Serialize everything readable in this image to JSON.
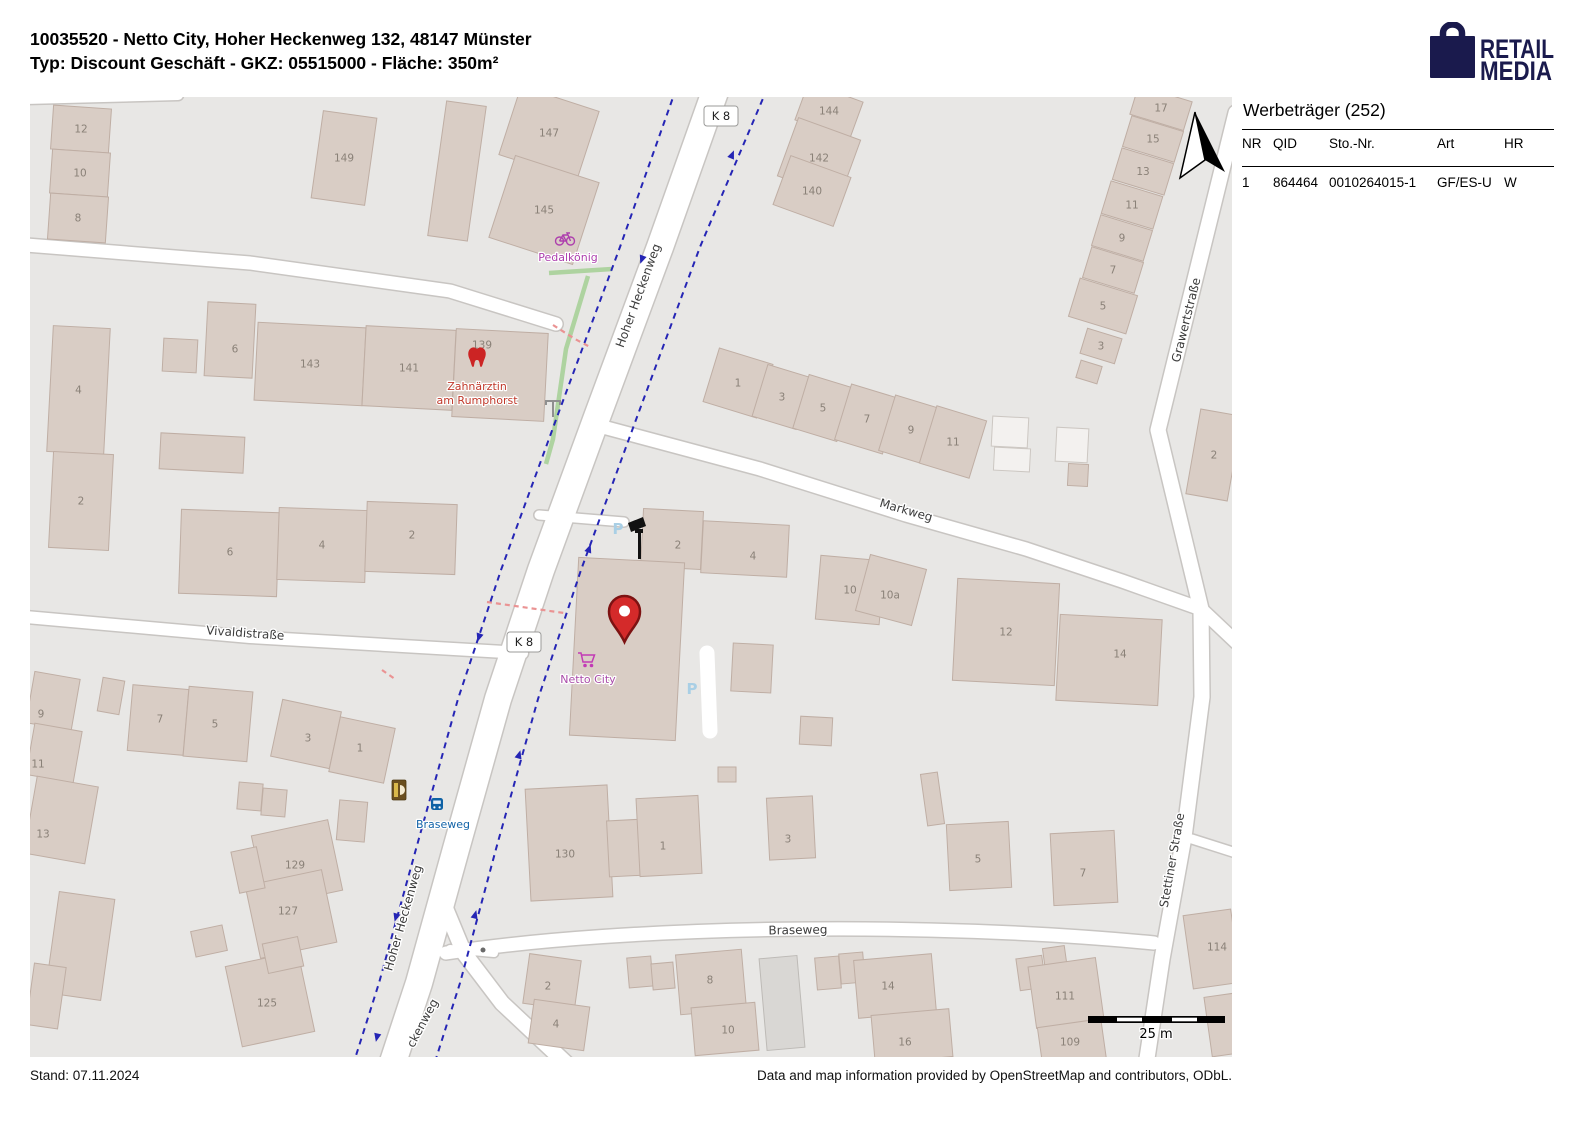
{
  "header": {
    "line1": "10035520 - Netto City, Hoher Heckenweg 132, 48147 Münster",
    "line2": "Typ: Discount Geschäft - GKZ: 05515000 - Fläche: 350m²",
    "logo": {
      "line1": "RETAIL",
      "line2": "MEDIA",
      "color": "#1a1a4d"
    }
  },
  "panel": {
    "title": "Werbeträger (252)",
    "columns": [
      "NR",
      "QID",
      "Sto.-Nr.",
      "Art",
      "HR"
    ],
    "rows": [
      [
        "1",
        "864464",
        "0010264015-1",
        "GF/ES-U",
        "W"
      ]
    ]
  },
  "footer": {
    "left": "Stand: 07.11.2024",
    "right": "Data and map information provided by OpenStreetMap and contributors, ODbL."
  },
  "map": {
    "colors": {
      "background": "#e8e7e5",
      "road": "#ffffff",
      "casing": "#c8c5c2",
      "building": "#d9cdc5",
      "cycleway": "#2525b5",
      "hedge": "#aed3a0",
      "poi_magenta": "#ad3fad",
      "poi_red": "#c0392b",
      "poi_purple": "#a94ca9",
      "transit_blue": "#1464a8",
      "pin_red": "#d42a2a"
    },
    "scale_label": "25 m",
    "parking_symbol": "P",
    "parking_positions": [
      {
        "x": 588,
        "y": 437
      },
      {
        "x": 662,
        "y": 597
      }
    ],
    "road_refs": [
      {
        "label": "K 8",
        "x": 691,
        "y": 19
      },
      {
        "label": "K 8",
        "x": 494,
        "y": 545
      }
    ],
    "street_labels": [
      {
        "text": "Hoher Heckenweg",
        "x": 612,
        "y": 200,
        "r": -70
      },
      {
        "text": "Hoher Heckenweg",
        "x": 377,
        "y": 822,
        "r": -74
      },
      {
        "text": "ckenweg",
        "x": 396,
        "y": 928,
        "r": -62
      },
      {
        "text": "Vivaldistraße",
        "x": 215,
        "y": 540,
        "r": 4
      },
      {
        "text": "Markweg",
        "x": 875,
        "y": 417,
        "r": 16
      },
      {
        "text": "Braseweg",
        "x": 768,
        "y": 837,
        "r": -1
      },
      {
        "text": "Grawertstraße",
        "x": 1160,
        "y": 224,
        "r": -76
      },
      {
        "text": "Stettiner Straße",
        "x": 1146,
        "y": 764,
        "r": -80
      }
    ],
    "pois": {
      "bike_shop": {
        "label": "Pedalkönig"
      },
      "dentist": {
        "label_line1": "Zahnärztin",
        "label_line2": "am Rumphorst"
      },
      "supermarket": {
        "label": "Netto City"
      },
      "bus_stop": {
        "label": "Braseweg"
      }
    },
    "buildings": [
      {
        "n": "12",
        "x": 22,
        "y": 10,
        "w": 58,
        "h": 44,
        "r": 4
      },
      {
        "n": "10",
        "x": 21,
        "y": 54,
        "w": 58,
        "h": 44,
        "r": 4
      },
      {
        "n": "8",
        "x": 19,
        "y": 98,
        "w": 58,
        "h": 46,
        "r": 4
      },
      {
        "n": "149",
        "x": 287,
        "y": 17,
        "w": 54,
        "h": 88,
        "r": 8
      },
      {
        "x": 407,
        "y": 6,
        "w": 40,
        "h": 136,
        "r": 8
      },
      {
        "n": "147",
        "x": 478,
        "y": 0,
        "w": 82,
        "h": 72,
        "r": 18
      },
      {
        "n": "145",
        "x": 470,
        "y": 70,
        "w": 88,
        "h": 86,
        "r": 18
      },
      {
        "x": 133,
        "y": 242,
        "w": 34,
        "h": 33,
        "r": 3
      },
      {
        "n": "6",
        "x": 176,
        "y": 206,
        "w": 48,
        "h": 74,
        "r": 3,
        "lx": 205,
        "ly": 252
      },
      {
        "n": "143",
        "x": 226,
        "y": 228,
        "w": 108,
        "h": 78,
        "r": 3
      },
      {
        "n": "141",
        "x": 334,
        "y": 231,
        "w": 90,
        "h": 80,
        "r": 3
      },
      {
        "n": "139",
        "x": 424,
        "y": 234,
        "w": 92,
        "h": 88,
        "r": 3,
        "lx": 452,
        "ly": 248
      },
      {
        "n": "4",
        "x": 20,
        "y": 230,
        "w": 57,
        "h": 126,
        "r": 3
      },
      {
        "n": "2",
        "x": 21,
        "y": 356,
        "w": 60,
        "h": 96,
        "r": 3
      },
      {
        "x": 130,
        "y": 338,
        "w": 84,
        "h": 36,
        "r": 3
      },
      {
        "n": "6",
        "x": 150,
        "y": 414,
        "w": 98,
        "h": 84,
        "r": 2,
        "lx": 200,
        "ly": 455
      },
      {
        "n": "4",
        "x": 248,
        "y": 412,
        "w": 88,
        "h": 72,
        "r": 2
      },
      {
        "n": "2",
        "x": 336,
        "y": 406,
        "w": 90,
        "h": 70,
        "r": 2,
        "lx": 382,
        "ly": 438
      },
      {
        "n": "144",
        "x": 770,
        "y": -6,
        "w": 58,
        "h": 40,
        "r": 20
      },
      {
        "n": "142",
        "x": 756,
        "y": 30,
        "w": 66,
        "h": 62,
        "r": 20
      },
      {
        "n": "140",
        "x": 750,
        "y": 68,
        "w": 64,
        "h": 52,
        "r": 20
      },
      {
        "n": "1",
        "x": 680,
        "y": 258,
        "w": 56,
        "h": 56,
        "r": 17
      },
      {
        "n": "3",
        "x": 729,
        "y": 273,
        "w": 46,
        "h": 54,
        "r": 17
      },
      {
        "n": "5",
        "x": 770,
        "y": 283,
        "w": 46,
        "h": 56,
        "r": 17
      },
      {
        "n": "7",
        "x": 812,
        "y": 293,
        "w": 50,
        "h": 58,
        "r": 17
      },
      {
        "n": "9",
        "x": 856,
        "y": 304,
        "w": 50,
        "h": 58,
        "r": 17
      },
      {
        "n": "11",
        "x": 897,
        "y": 315,
        "w": 52,
        "h": 60,
        "r": 17
      },
      {
        "n": "17",
        "x": 1103,
        "y": -4,
        "w": 56,
        "h": 30,
        "r": 17
      },
      {
        "n": "15",
        "x": 1096,
        "y": 26,
        "w": 54,
        "h": 32,
        "r": 17
      },
      {
        "n": "13",
        "x": 1086,
        "y": 58,
        "w": 54,
        "h": 33,
        "r": 17
      },
      {
        "n": "11",
        "x": 1075,
        "y": 91,
        "w": 54,
        "h": 34,
        "r": 17
      },
      {
        "n": "9",
        "x": 1065,
        "y": 125,
        "w": 54,
        "h": 32,
        "r": 17
      },
      {
        "n": "7",
        "x": 1056,
        "y": 157,
        "w": 54,
        "h": 32,
        "r": 17
      },
      {
        "n": "5",
        "x": 1043,
        "y": 189,
        "w": 60,
        "h": 40,
        "r": 17
      },
      {
        "n": "3",
        "x": 1053,
        "y": 236,
        "w": 36,
        "h": 26,
        "r": 17
      },
      {
        "x": 1048,
        "y": 266,
        "w": 22,
        "h": 18,
        "r": 17
      },
      {
        "n": "2",
        "x": 1163,
        "y": 315,
        "w": 42,
        "h": 86,
        "r": 10
      },
      {
        "n": "2",
        "x": 612,
        "y": 413,
        "w": 60,
        "h": 58,
        "r": 3,
        "lx": 648,
        "ly": 448
      },
      {
        "n": "4",
        "x": 672,
        "y": 426,
        "w": 86,
        "h": 52,
        "r": 3,
        "lx": 723,
        "ly": 459
      },
      {
        "x": 544,
        "y": 463,
        "w": 106,
        "h": 178,
        "r": 3,
        "name": "netto-building"
      },
      {
        "n": "10",
        "x": 788,
        "y": 461,
        "w": 64,
        "h": 64,
        "r": 5
      },
      {
        "n": "10a",
        "x": 832,
        "y": 464,
        "w": 58,
        "h": 58,
        "r": 15,
        "lx": 860,
        "ly": 498
      },
      {
        "n": "12",
        "x": 925,
        "y": 484,
        "w": 102,
        "h": 102,
        "r": 3
      },
      {
        "n": "14",
        "x": 1028,
        "y": 520,
        "w": 102,
        "h": 86,
        "r": 3,
        "lx": 1090,
        "ly": 557
      },
      {
        "x": 962,
        "y": 320,
        "w": 36,
        "h": 30,
        "r": 3,
        "v": "light"
      },
      {
        "x": 964,
        "y": 351,
        "w": 36,
        "h": 23,
        "r": 3,
        "v": "light"
      },
      {
        "x": 1026,
        "y": 331,
        "w": 32,
        "h": 34,
        "r": 3,
        "v": "light"
      },
      {
        "x": 1038,
        "y": 367,
        "w": 20,
        "h": 22,
        "r": 3
      },
      {
        "x": 702,
        "y": 547,
        "w": 40,
        "h": 48,
        "r": 3
      },
      {
        "x": 770,
        "y": 620,
        "w": 32,
        "h": 28,
        "r": 3
      },
      {
        "n": "9",
        "x": 0,
        "y": 578,
        "w": 46,
        "h": 52,
        "r": 10,
        "lx": 11,
        "ly": 617
      },
      {
        "n": "11",
        "x": 0,
        "y": 630,
        "w": 48,
        "h": 52,
        "r": 10,
        "lx": 8,
        "ly": 667
      },
      {
        "n": "13",
        "x": 0,
        "y": 684,
        "w": 62,
        "h": 78,
        "r": 10,
        "lx": 13,
        "ly": 737
      },
      {
        "x": 70,
        "y": 582,
        "w": 22,
        "h": 34,
        "r": 10
      },
      {
        "n": "7",
        "x": 100,
        "y": 590,
        "w": 56,
        "h": 66,
        "r": 5,
        "lx": 130,
        "ly": 622
      },
      {
        "n": "5",
        "x": 156,
        "y": 592,
        "w": 64,
        "h": 70,
        "r": 5,
        "lx": 185,
        "ly": 627
      },
      {
        "n": "3",
        "x": 246,
        "y": 608,
        "w": 60,
        "h": 58,
        "r": 12,
        "lx": 278,
        "ly": 641
      },
      {
        "n": "1",
        "x": 304,
        "y": 625,
        "w": 56,
        "h": 56,
        "r": 12,
        "lx": 330,
        "ly": 651
      },
      {
        "x": 208,
        "y": 686,
        "w": 24,
        "h": 27,
        "r": 5
      },
      {
        "x": 232,
        "y": 692,
        "w": 24,
        "h": 27,
        "r": 5
      },
      {
        "x": 308,
        "y": 704,
        "w": 28,
        "h": 40,
        "r": 5
      },
      {
        "n": "129",
        "x": 228,
        "y": 730,
        "w": 78,
        "h": 72,
        "r": -12,
        "lx": 265,
        "ly": 768
      },
      {
        "n": "127",
        "x": 222,
        "y": 780,
        "w": 78,
        "h": 74,
        "r": -12,
        "lx": 258,
        "ly": 814
      },
      {
        "x": 205,
        "y": 752,
        "w": 26,
        "h": 42,
        "r": -12
      },
      {
        "n": "125",
        "x": 203,
        "y": 861,
        "w": 74,
        "h": 82,
        "r": -12,
        "lx": 237,
        "ly": 906
      },
      {
        "x": 235,
        "y": 843,
        "w": 36,
        "h": 30,
        "r": -12
      },
      {
        "x": 163,
        "y": 831,
        "w": 32,
        "h": 26,
        "r": -12
      },
      {
        "x": 22,
        "y": 798,
        "w": 56,
        "h": 102,
        "r": 8
      },
      {
        "x": 0,
        "y": 868,
        "w": 32,
        "h": 62,
        "r": 8
      },
      {
        "n": "130",
        "x": 498,
        "y": 690,
        "w": 82,
        "h": 112,
        "r": -3,
        "lx": 535,
        "ly": 757
      },
      {
        "x": 578,
        "y": 723,
        "w": 36,
        "h": 56,
        "r": -3
      },
      {
        "n": "1",
        "x": 608,
        "y": 700,
        "w": 62,
        "h": 78,
        "r": -3,
        "lx": 633,
        "ly": 749
      },
      {
        "n": "3",
        "x": 738,
        "y": 700,
        "w": 46,
        "h": 62,
        "r": -3,
        "lx": 758,
        "ly": 742
      },
      {
        "x": 688,
        "y": 670,
        "w": 18,
        "h": 15,
        "r": 0
      },
      {
        "x": 894,
        "y": 676,
        "w": 17,
        "h": 52,
        "r": -8
      },
      {
        "n": "5",
        "x": 918,
        "y": 726,
        "w": 62,
        "h": 66,
        "r": -3,
        "lx": 948,
        "ly": 762
      },
      {
        "n": "7",
        "x": 1022,
        "y": 735,
        "w": 64,
        "h": 72,
        "r": -3,
        "lx": 1053,
        "ly": 776
      },
      {
        "n": "2",
        "x": 496,
        "y": 860,
        "w": 52,
        "h": 50,
        "r": 8,
        "lx": 518,
        "ly": 889
      },
      {
        "n": "4",
        "x": 501,
        "y": 906,
        "w": 56,
        "h": 44,
        "r": 8,
        "lx": 526,
        "ly": 927
      },
      {
        "x": 598,
        "y": 860,
        "w": 24,
        "h": 30,
        "r": -5
      },
      {
        "x": 622,
        "y": 866,
        "w": 22,
        "h": 26,
        "r": -5
      },
      {
        "n": "8",
        "x": 648,
        "y": 855,
        "w": 66,
        "h": 60,
        "r": -5,
        "lx": 680,
        "ly": 883
      },
      {
        "n": "10",
        "x": 663,
        "y": 908,
        "w": 64,
        "h": 48,
        "r": -5,
        "lx": 698,
        "ly": 933
      },
      {
        "x": 733,
        "y": 860,
        "w": 38,
        "h": 92,
        "r": -5,
        "v": "gray"
      },
      {
        "x": 786,
        "y": 860,
        "w": 24,
        "h": 32,
        "r": -5
      },
      {
        "x": 810,
        "y": 856,
        "w": 24,
        "h": 30,
        "r": -5
      },
      {
        "n": "14",
        "x": 826,
        "y": 860,
        "w": 78,
        "h": 58,
        "r": -5,
        "lx": 858,
        "ly": 889
      },
      {
        "n": "16",
        "x": 843,
        "y": 915,
        "w": 78,
        "h": 48,
        "r": -5,
        "lx": 875,
        "ly": 945
      },
      {
        "x": 988,
        "y": 860,
        "w": 26,
        "h": 32,
        "r": -8
      },
      {
        "x": 1014,
        "y": 850,
        "w": 22,
        "h": 24,
        "r": -8
      },
      {
        "n": "111",
        "x": 1002,
        "y": 865,
        "w": 68,
        "h": 62,
        "r": -8,
        "lx": 1035,
        "ly": 899
      },
      {
        "n": "109",
        "x": 1010,
        "y": 926,
        "w": 64,
        "h": 42,
        "r": -8,
        "lx": 1040,
        "ly": 945
      },
      {
        "n": "114",
        "x": 1158,
        "y": 815,
        "w": 48,
        "h": 74,
        "r": -8,
        "lx": 1187,
        "ly": 850
      },
      {
        "x": 1178,
        "y": 898,
        "w": 30,
        "h": 60,
        "r": -8
      }
    ]
  }
}
